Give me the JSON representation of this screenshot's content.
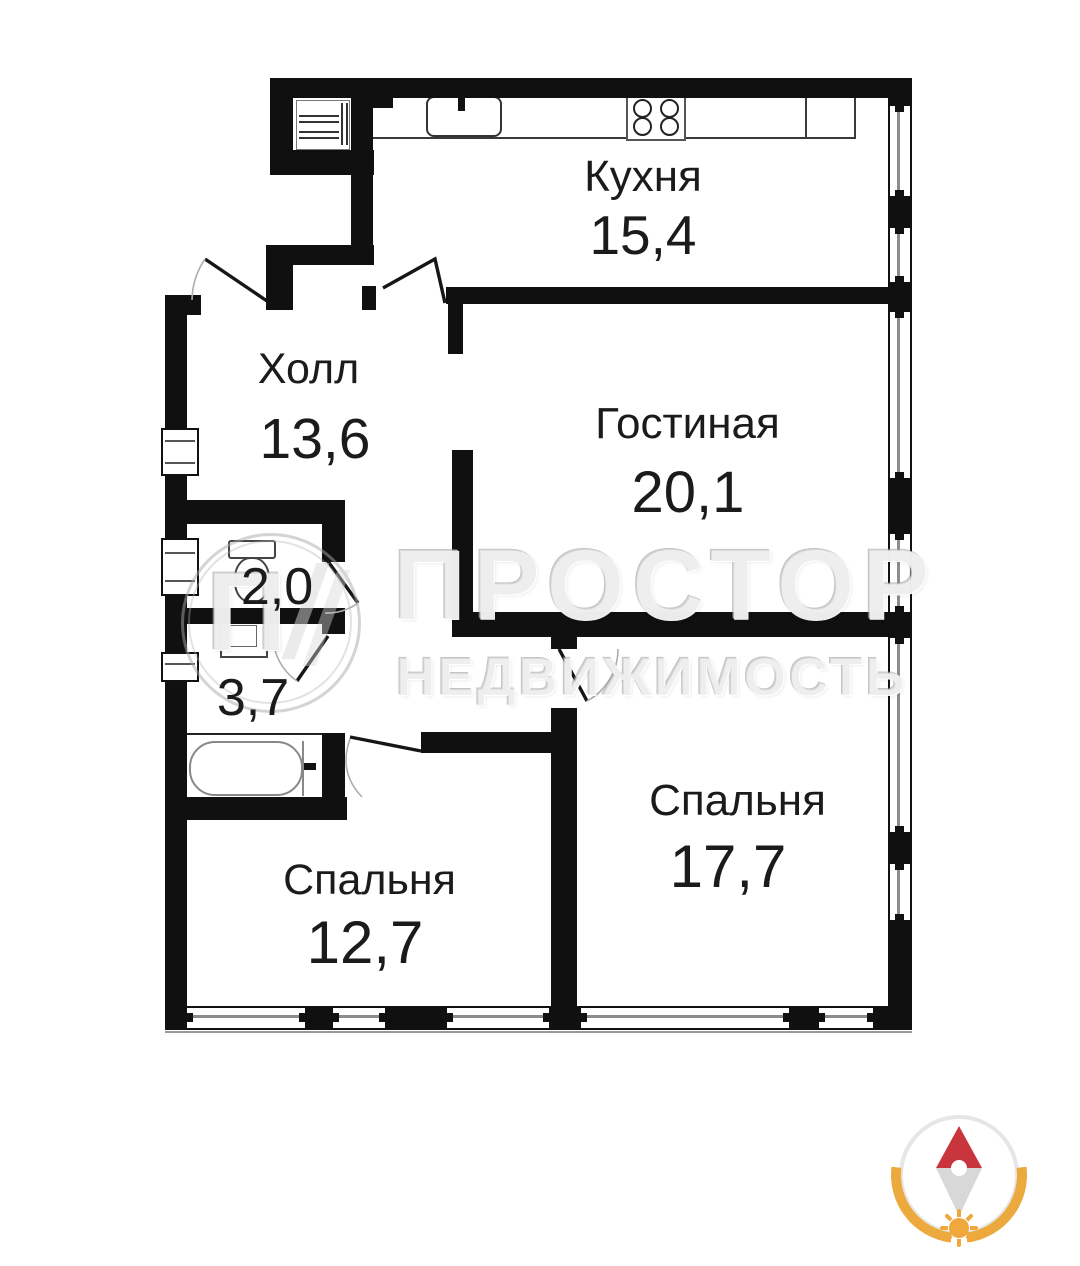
{
  "rooms": {
    "kitchen": {
      "name": "Кухня",
      "area": "15,4"
    },
    "hall": {
      "name": "Холл",
      "area": "13,6"
    },
    "living": {
      "name": "Гостиная",
      "area": "20,1"
    },
    "wc": {
      "area": "2,0"
    },
    "bathroom": {
      "area": "3,7"
    },
    "bedroom_right": {
      "name": "Спальня",
      "area": "17,7"
    },
    "bedroom_left": {
      "name": "Спальня",
      "area": "12,7"
    }
  },
  "watermark": {
    "title": "ПРОСТОР",
    "subtitle": "НЕДВИЖИМОСТЬ",
    "logo_letter": "П"
  },
  "icons": {
    "compass": "compass-north-icon",
    "sun": "sun-icon",
    "stove": "stove-burners-icon",
    "sink": "kitchen-sink-icon",
    "bathtub": "bathtub-icon",
    "toilet": "toilet-icon",
    "washbasin": "washbasin-icon"
  },
  "colors": {
    "wall": "#101010",
    "watermark_gray": "#e5e5e5",
    "compass_red": "#c8353c",
    "compass_tail_gray": "#d8d8d8",
    "compass_orange": "#ecaa3e",
    "window_glass": "#8c8c8c"
  }
}
